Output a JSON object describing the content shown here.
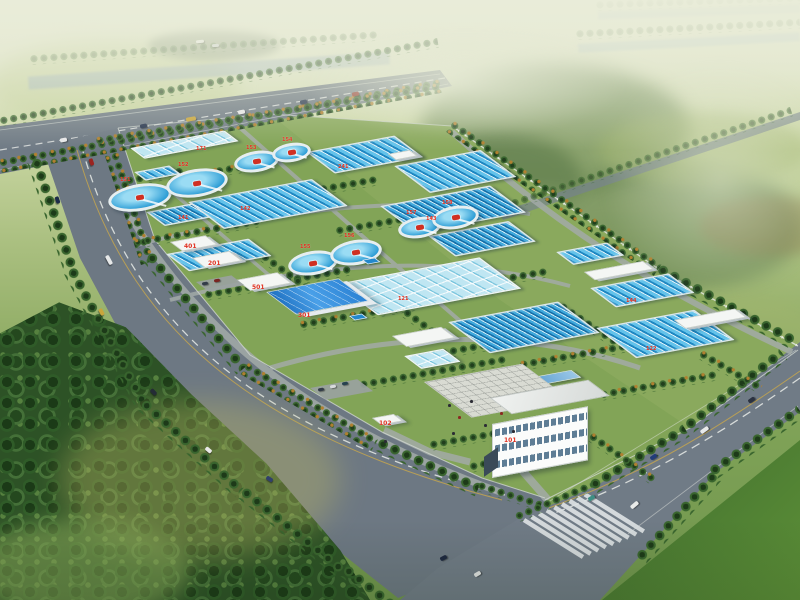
{
  "scene": {
    "kind": "aerial-rendering",
    "subject": "water-treatment-plant"
  },
  "labels": {
    "admin_building": "101",
    "gatehouse": "102",
    "workshop": "301",
    "aux_building_1": "401",
    "aux_building_2": "201",
    "aux_building_3": "501",
    "basin_groups": [
      "141",
      "142",
      "143",
      "144",
      "121",
      "122",
      "171",
      "241"
    ],
    "clarifiers": [
      "151",
      "152",
      "153",
      "154",
      "155",
      "156",
      "157",
      "158"
    ]
  },
  "counts": {
    "circular_clarifiers": 8,
    "rectangular_basin_groups": 14,
    "labeled_buildings": 6
  },
  "palette": {
    "haze": "#e9ecd9",
    "lawn": "#82a457",
    "tree_green": "#2f5b28",
    "forest_dark": "#24481e",
    "road_gray": "#6f7a85",
    "water_dark": "#1f86c0",
    "water_mid": "#2f9cd4",
    "water_pale": "#9fd8ea",
    "tank_rim": "#e6eef0",
    "roof_blue": "#2b82d4",
    "building_white": "#f4f6f4",
    "label_red": "#e03020",
    "grass_dark": "#3c682c",
    "lane_yellow": "#c9a84b"
  }
}
